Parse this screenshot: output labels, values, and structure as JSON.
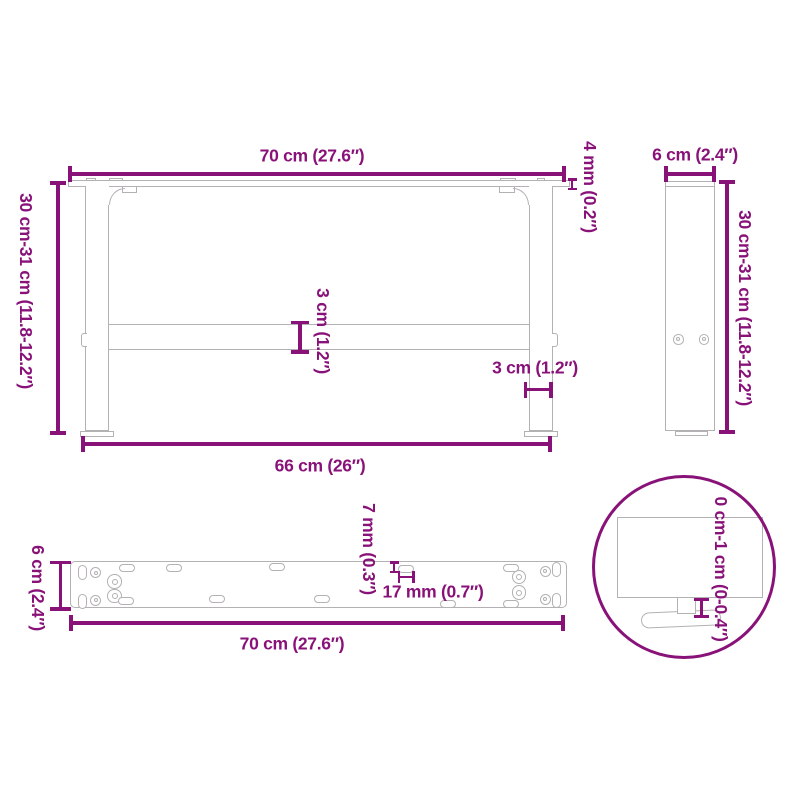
{
  "colors": {
    "accent": "#891279",
    "drawing_line": "#b3b1b3"
  },
  "front_view": {
    "top_width": "70 cm (27.6″)",
    "left_height": "30 cm-31 cm (11.8-12.2″)",
    "plate_thickness": "4 mm (0.2″)",
    "crossbar_thickness": "3 cm (1.2″)",
    "leg_thickness": "3 cm (1.2″)",
    "bottom_width": "66 cm (26″)"
  },
  "side_view": {
    "top_depth": "6 cm (2.4″)",
    "right_height": "30 cm-31 cm (11.8-12.2″)"
  },
  "plate_view": {
    "left_depth": "6 cm (2.4″)",
    "slot_width": "7 mm (0.3″)",
    "slot_length": "17 mm (0.7″)",
    "bottom_width": "70 cm (27.6″)"
  },
  "detail_view": {
    "foot_adjustment": "0 cm-1 cm (0-0.4″)"
  }
}
